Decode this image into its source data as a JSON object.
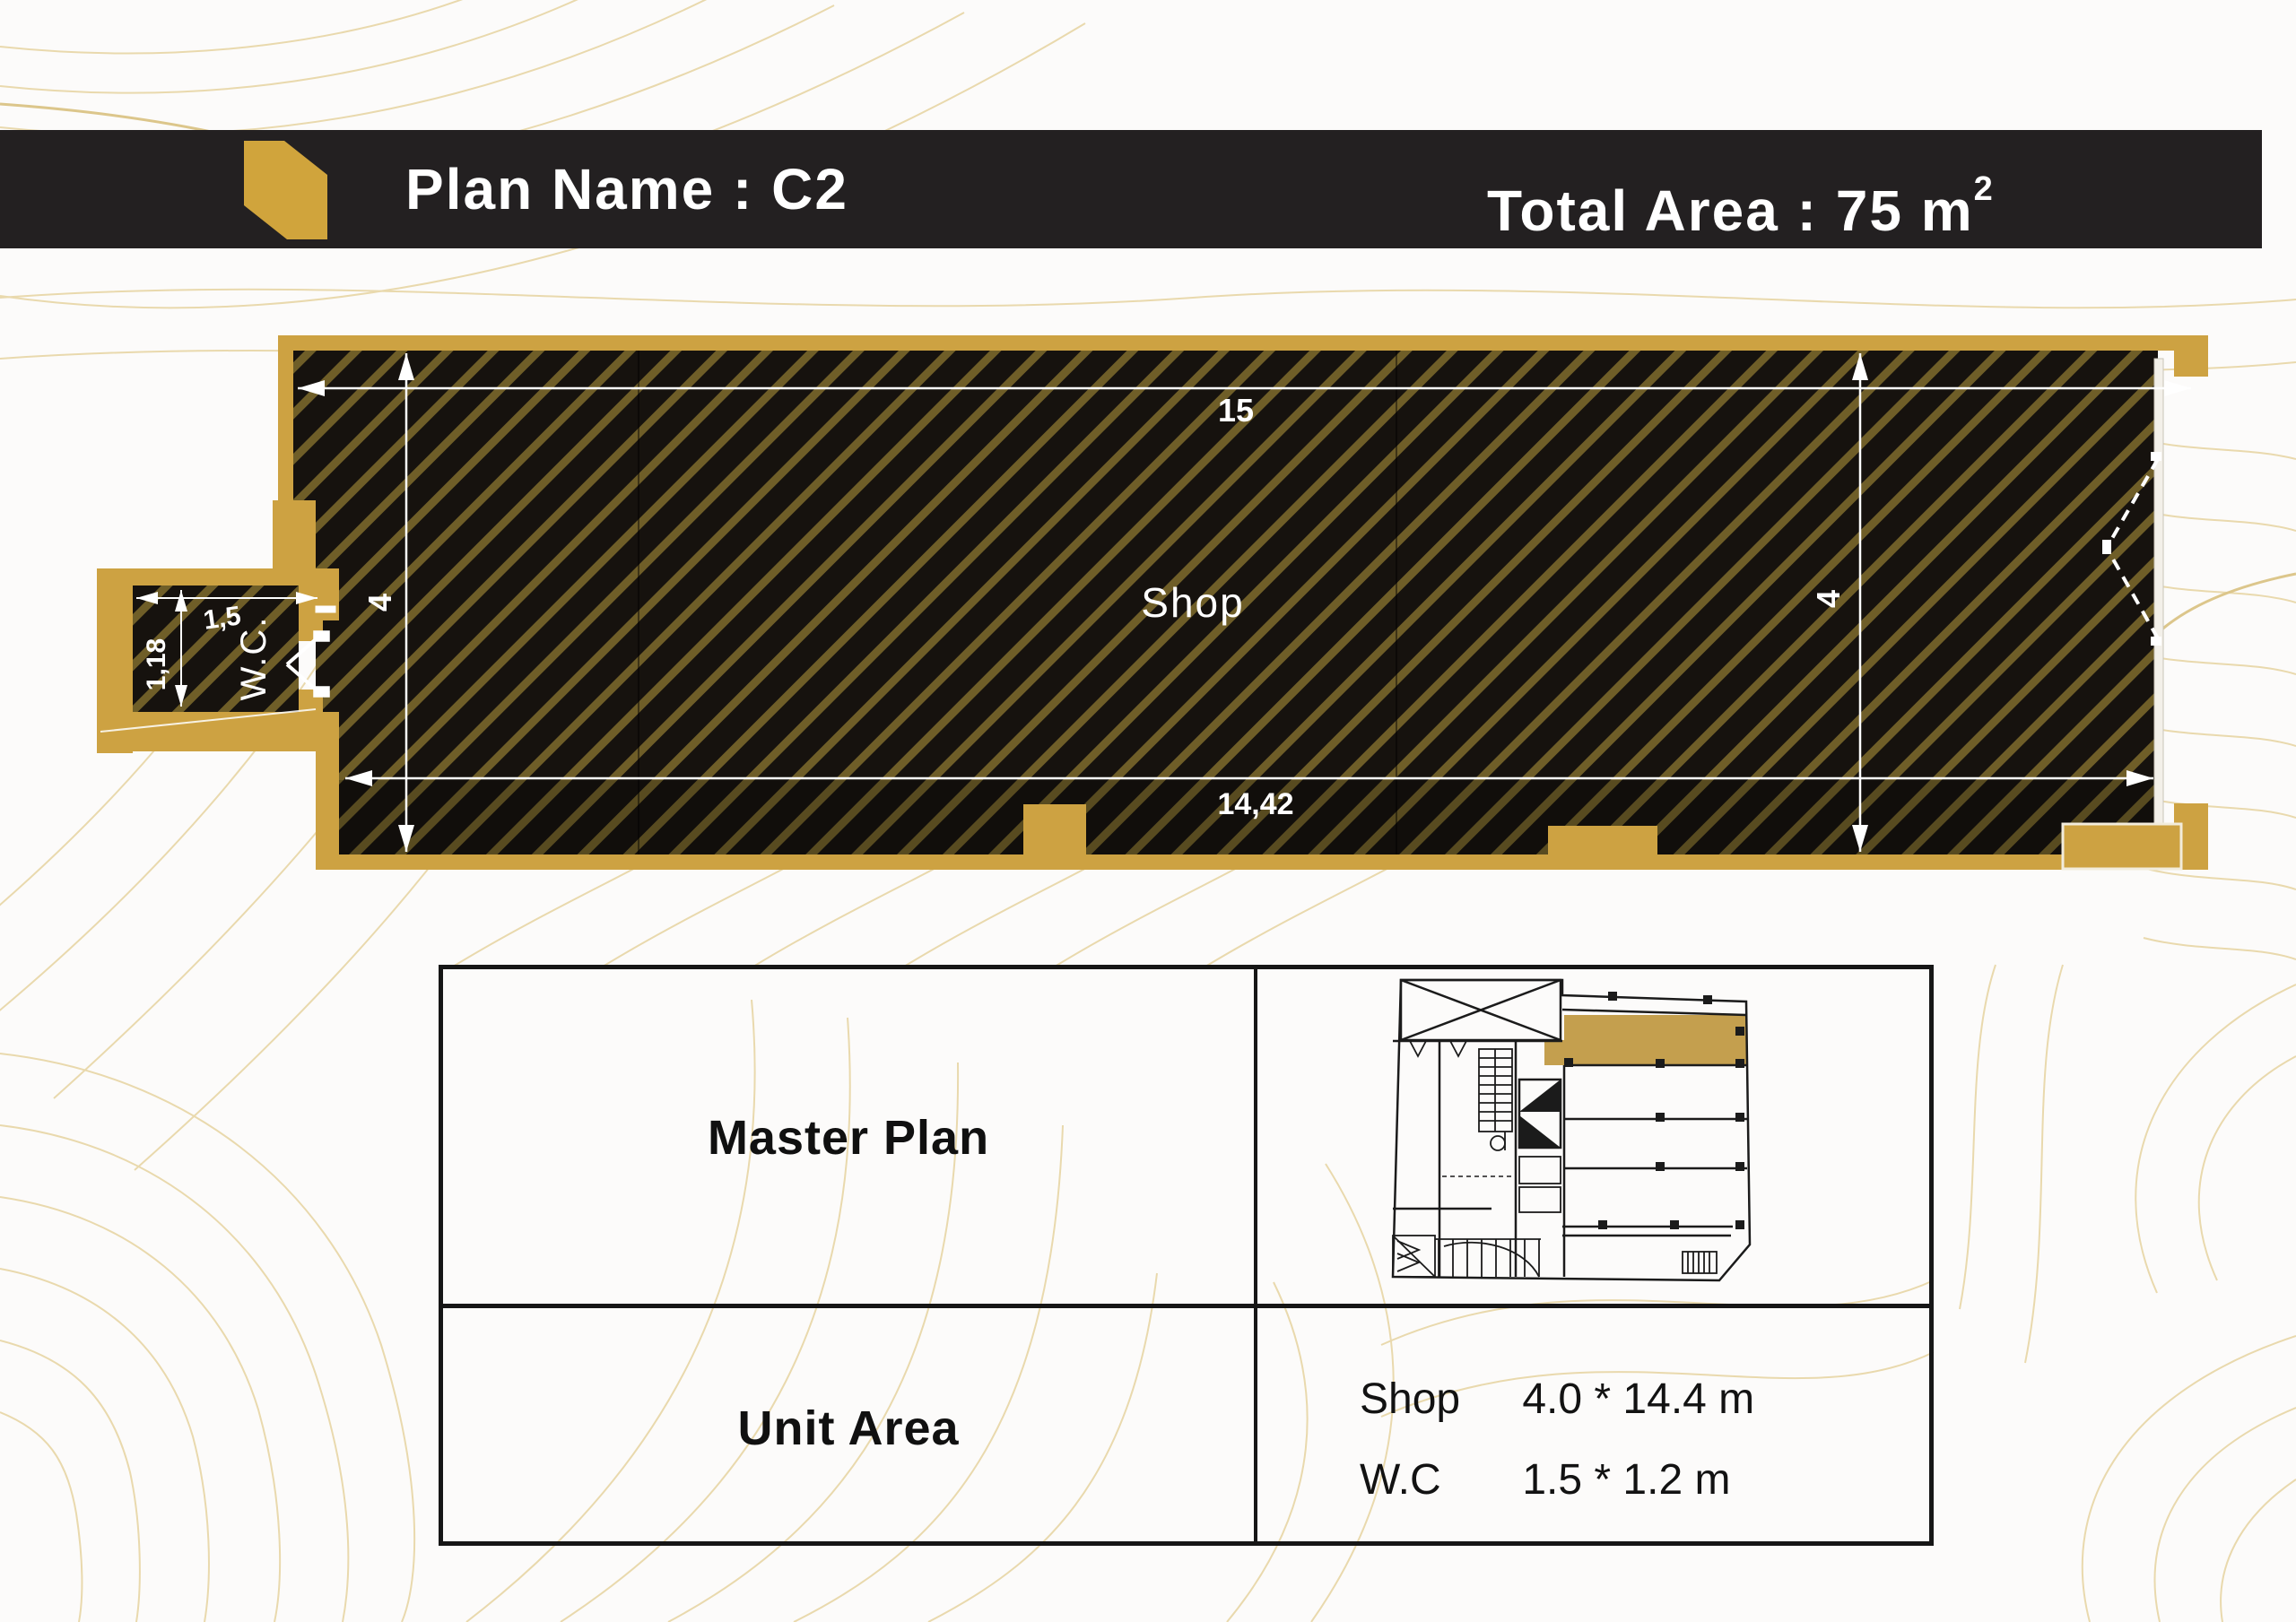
{
  "header": {
    "plan_name": "Plan Name : C2",
    "total_area": "Total Area : 75 m",
    "total_area_sup": "2"
  },
  "floor_plan": {
    "room_label": "Shop",
    "wc_label": "W.C.",
    "dim_width_top": "15",
    "dim_height_left": "4",
    "dim_height_right": "4",
    "dim_width_bottom": "14,42",
    "wc_dim_width": "1,5",
    "wc_dim_height": "1,18"
  },
  "table": {
    "master_plan_label": "Master Plan",
    "unit_area_label": "Unit Area",
    "unit_rows": [
      {
        "name": "Shop",
        "dims": "4.0 * 14.4 m"
      },
      {
        "name": "W.C",
        "dims": "1.5 * 1.2 m"
      }
    ]
  },
  "colors": {
    "gold": "#cda242",
    "header_bg": "#232021",
    "hatch_bg": "#16120e",
    "hatch_stripe": "#6f5e28",
    "contour": "#e9d9ad"
  }
}
